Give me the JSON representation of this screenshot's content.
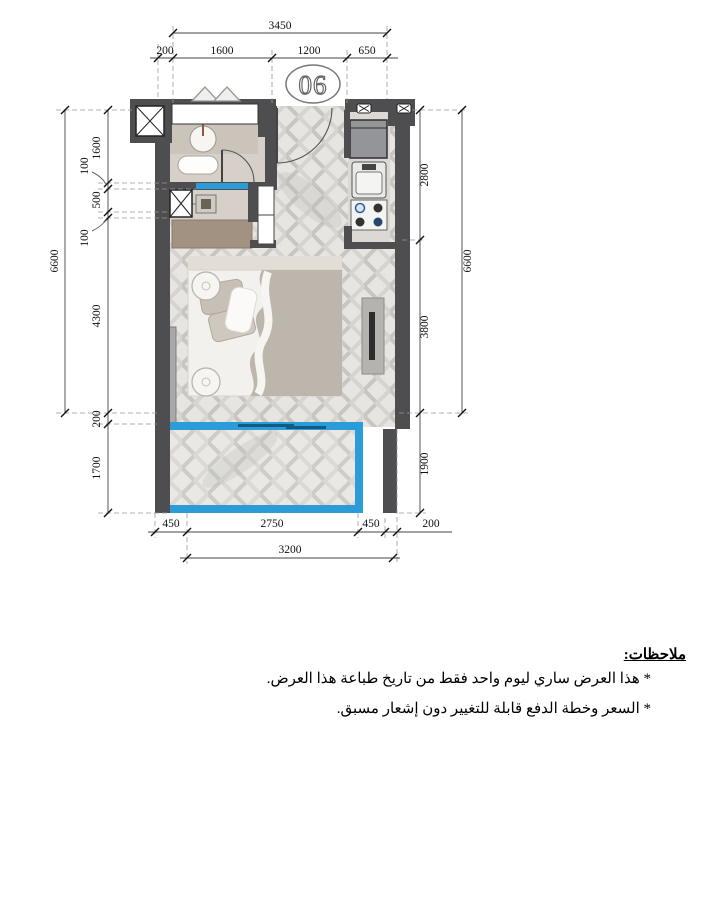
{
  "plan": {
    "unit_number": "06",
    "dims": {
      "top_total": "3450",
      "top_segments": [
        "200",
        "1600",
        "1200",
        "650"
      ],
      "left_total": "6600",
      "left_chain": [
        "1600",
        "100",
        "500",
        "100",
        "4300",
        "200",
        "1700"
      ],
      "right_chain": [
        "2800",
        "3800",
        "1900"
      ],
      "right_total": "6600",
      "bottom_segments": [
        "450",
        "2750",
        "450",
        "200"
      ],
      "bottom_total": "3200"
    },
    "colors": {
      "wall": "#4e4e50",
      "glazing_blue": "#2b9cd8",
      "floor_light": "#e7e5e2",
      "cabinet_tan": "#a29282"
    }
  },
  "notes": {
    "heading": "ملاحظات:",
    "items": [
      "* هذا العرض ساري ليوم واحد فقط من تاريخ طباعة هذا العرض.",
      "* السعر وخطة الدفع قابلة للتغيير دون إشعار مسبق."
    ]
  }
}
